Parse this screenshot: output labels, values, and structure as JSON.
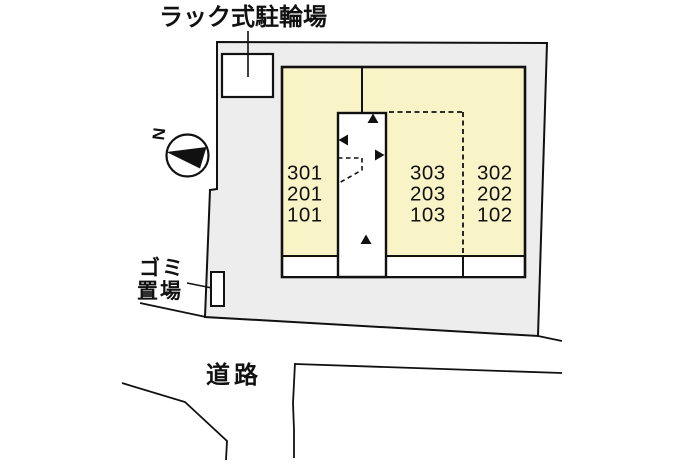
{
  "diagram": {
    "type": "building-site-plan",
    "labels": {
      "bike_parking": "ラック式駐輪場",
      "garbage_line1": "ゴミ",
      "garbage_line2": "置場",
      "road": "道路",
      "north": "N"
    },
    "building": {
      "left_units": [
        "301",
        "201",
        "101"
      ],
      "middle_units": [
        "303",
        "203",
        "103"
      ],
      "right_units": [
        "302",
        "202",
        "102"
      ]
    },
    "colors": {
      "site_fill": "#ededed",
      "building_fill": "#f9f4c8",
      "line": "#111111",
      "white": "#ffffff"
    }
  }
}
